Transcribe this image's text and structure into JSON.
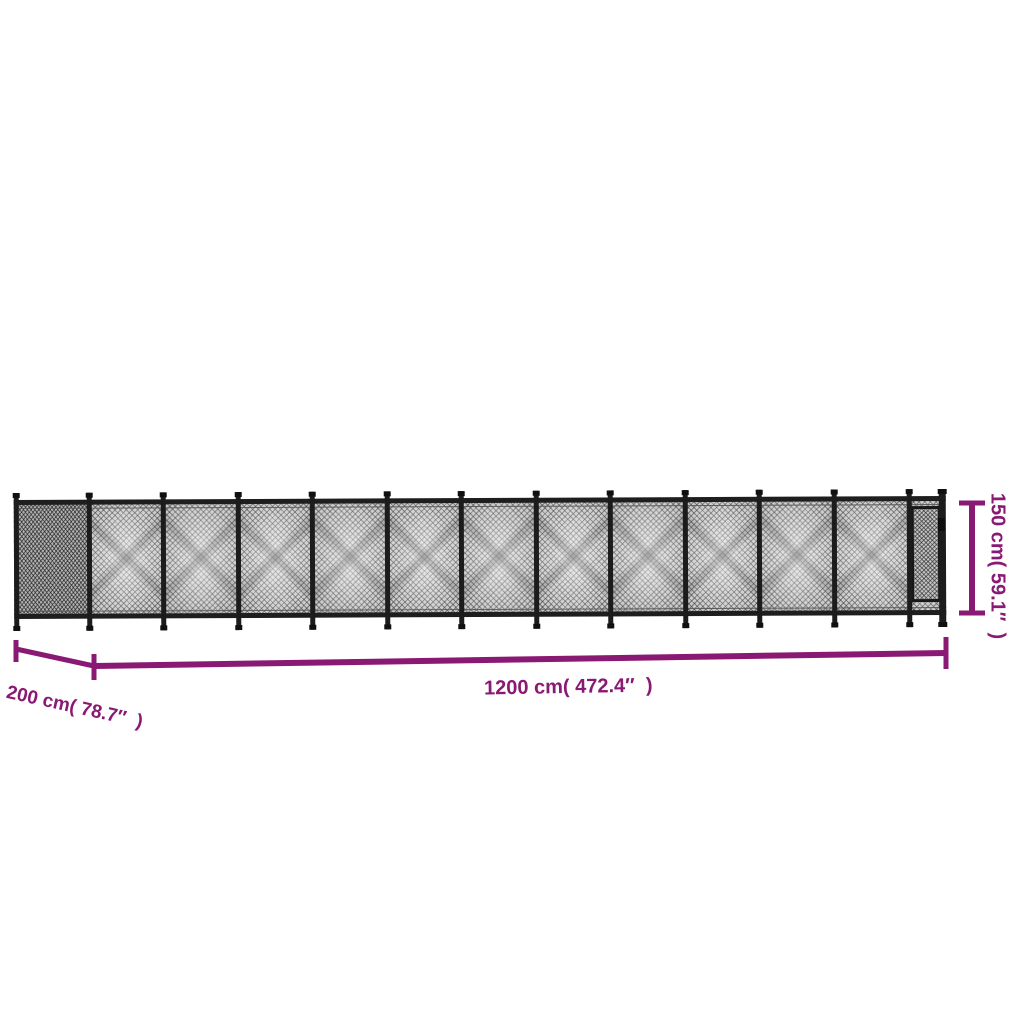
{
  "figure": {
    "description": "chain-link fence with gate, shown with overall dimensions",
    "background": "#ffffff"
  },
  "dimensions": {
    "length": {
      "label": "1200 cm( 472.4″  )",
      "value_cm": 1200,
      "value_in": 472.4
    },
    "depth": {
      "label": "200 cm( 78.7″  )",
      "value_cm": 200,
      "value_in": 78.7
    },
    "height": {
      "label": "150 cm( 59.1″  )",
      "value_cm": 150,
      "value_in": 59.1
    }
  },
  "colors": {
    "dimension": "#8a1973",
    "post": "#1c1c1c",
    "mesh": "#c7c7c7",
    "background": "#ffffff"
  },
  "fence": {
    "return_panels": 1,
    "main_panels": 11,
    "gates": 1
  }
}
